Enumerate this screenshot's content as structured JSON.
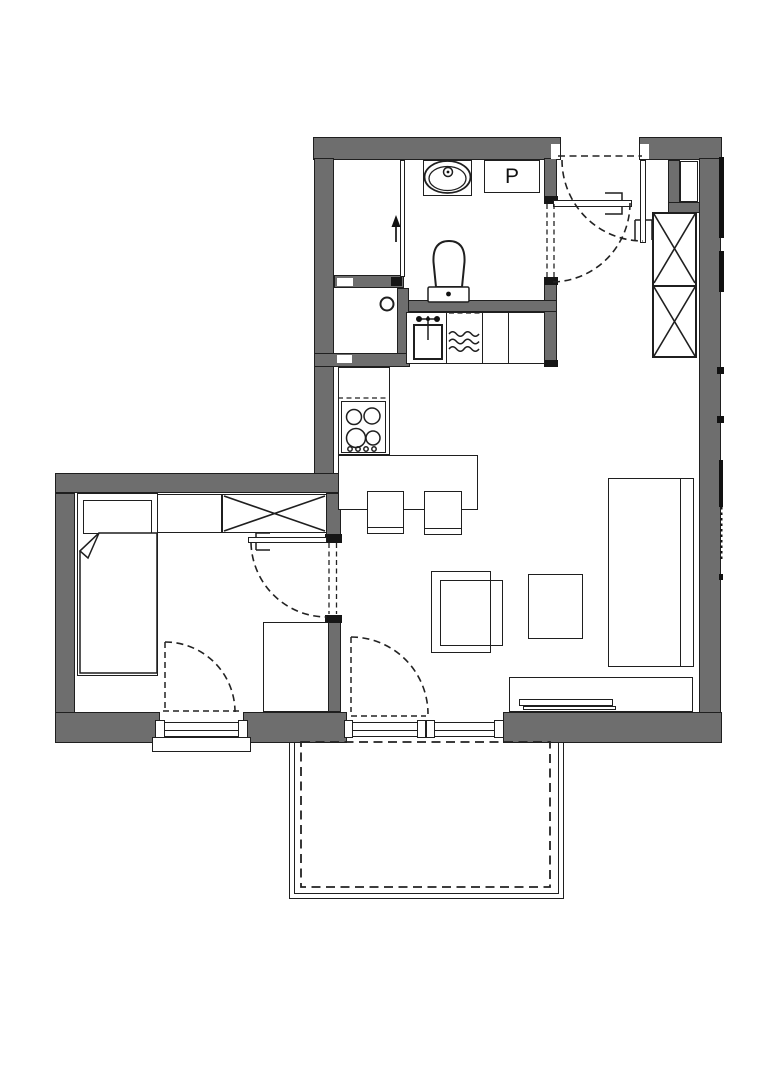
{
  "plan": {
    "washer_label": "P",
    "colors": {
      "wall": "#6e6e6e",
      "line": "#1f1f1f",
      "background": "#ffffff"
    },
    "rooms": [
      "bathroom",
      "entry-hall",
      "kitchen",
      "living-room",
      "bedroom",
      "balcony"
    ],
    "fixtures": [
      "shower",
      "washbasin",
      "washer-box",
      "toilet",
      "kitchen-sink",
      "dishwasher",
      "cooktop",
      "island-counter",
      "bar-stools",
      "hall-wardrobe",
      "duct-shaft",
      "bed",
      "nightstand",
      "bedroom-wardrobe",
      "desk",
      "sofa",
      "coffee-tables",
      "armchair",
      "tv-stand",
      "tv",
      "entrance-door",
      "bathroom-door",
      "bedroom-door",
      "bedroom-window",
      "balcony-door",
      "window-sill"
    ]
  }
}
